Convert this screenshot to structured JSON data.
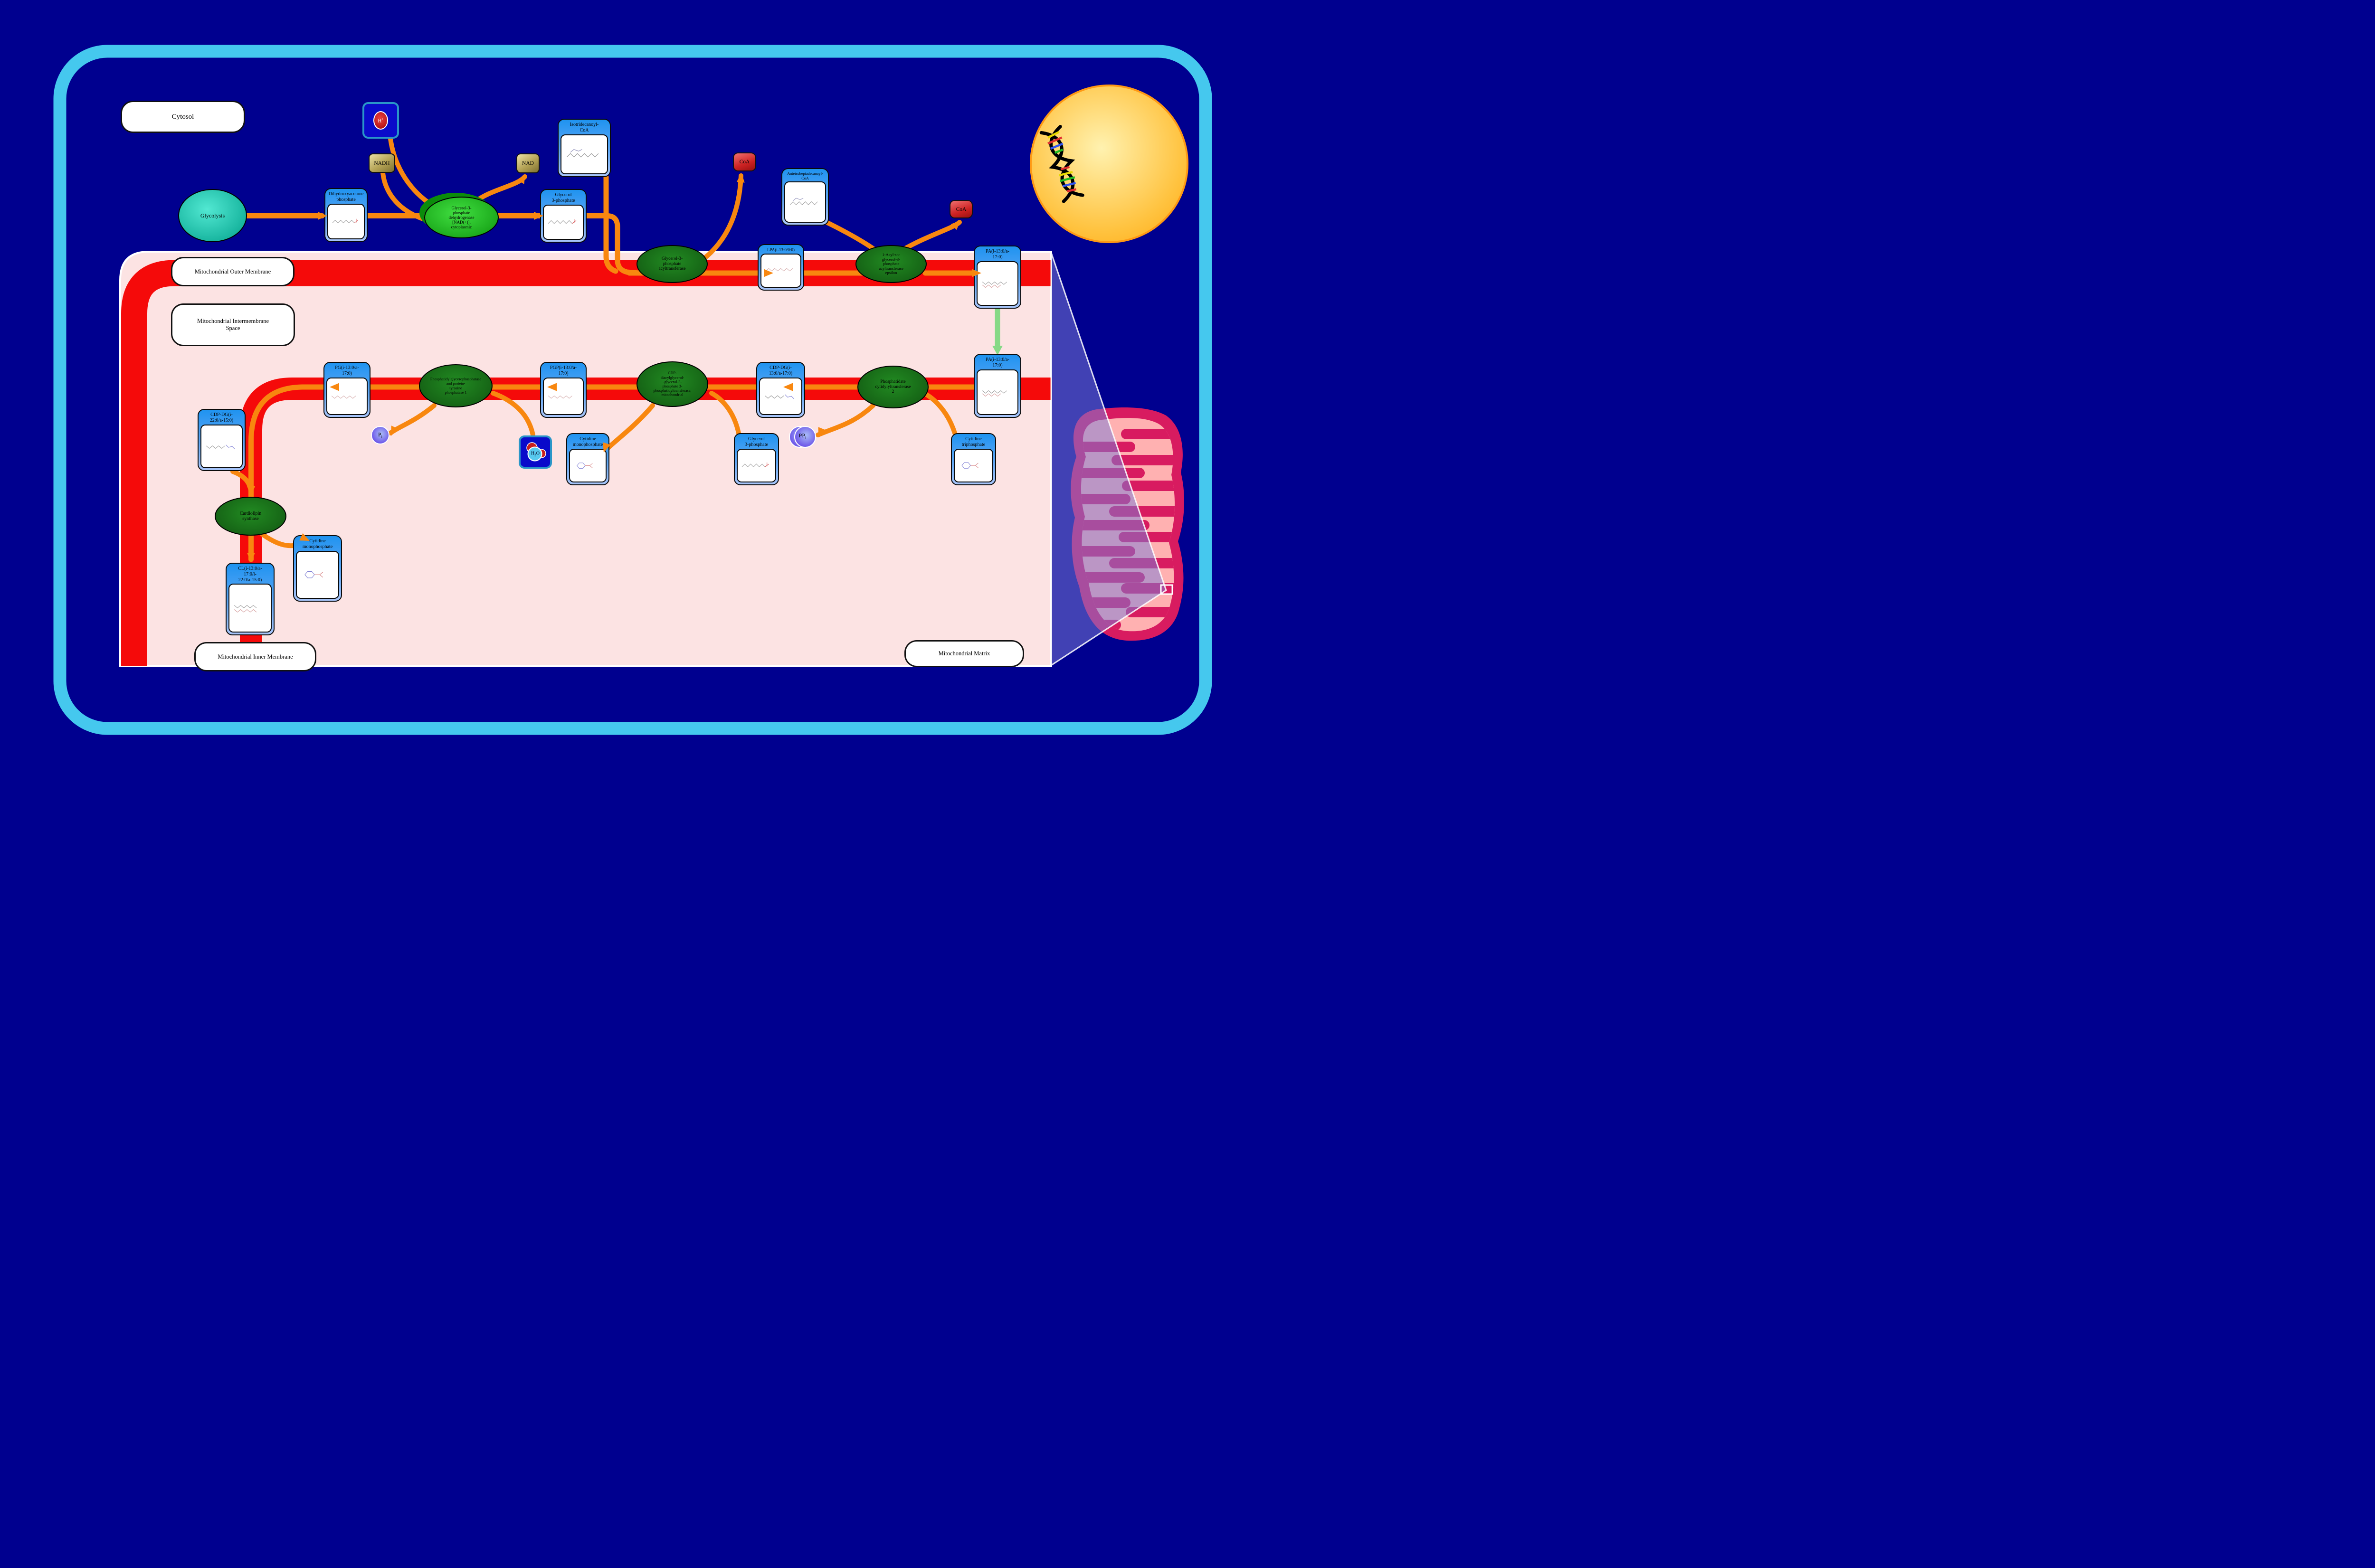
{
  "diagram_title": "Cardiolipin biosynthesis pathway",
  "compartment_labels": {
    "cytosol": "Cytosol",
    "outer_membrane": "Mitochondrial Outer Membrane",
    "intermembrane_space": "Mitochondrial Intermembrane\nSpace",
    "inner_membrane": "Mitochondrial Inner Membrane",
    "matrix": "Mitochondrial Matrix"
  },
  "processes": {
    "glycolysis": "Glycolysis"
  },
  "metabolites": {
    "dhap": "Dihydroxyacetone\nphosphate",
    "g3p_cytosol": "Glycerol\n3-phosphate",
    "iso_coa": "Isotridecanoyl-\nCoA",
    "anteiso_coa": "Anteisoheptadecanoyl-\nCoA",
    "lpa": "LPA(i-13:0/0:0)",
    "pa_outer": "PA(i-13:0/a-\n17:0)",
    "pa_inner": "PA(i-13:0/a-\n17:0)",
    "cdp_dg_1": "CDP-DG(i-\n13:0/a-17:0)",
    "pgp": "PGP(i-13:0/a-\n17:0)",
    "pg": "PG(i-13:0/a-\n17:0)",
    "cdp_dg_2": "CDP-DG(i-\n22:0/a-15:0)",
    "cl": "CL(i-13:0/a-\n17:0/i-\n22:0/a-15:0)",
    "cmp_upper": "Cytidine\nmonophosphate",
    "cmp_lower": "Cytidine\nmonophosphate",
    "g3p_matrix": "Glycerol\n3-phosphate",
    "ctp": "Cytidine\ntriphosphate"
  },
  "enzymes": {
    "g3p_dehydrogenase": "Glycerol-3-\nphosphate\ndehydrogenase\n[NAD(+)],\ncytoplasmic",
    "gpat": "Glycerol-3-\nphosphate\nacyltransferase",
    "agpat_epsilon": "1-Acyl-sn-\nglycerol-3-\nphosphate\nacyltransferase\nepsilon",
    "pcyt2": "Phosphatidate\ncytidylyltransferase\n2",
    "cds": "CDP-\ndiacylglycerol-\n-glycerol-3-\nphosphate 3-\nphosphatidyltransferase,\nmitochondrial",
    "ptpmt1": "Phosphatidylglycerophosphatase\nand protein-\ntyrosine\nphosphatase 1",
    "cardiolipin_synthase": "Cardiolipin\nsynthase"
  },
  "cofactors": {
    "nadh": "NADH",
    "nad": "NAD",
    "h_plus": {
      "base": "H",
      "sup": "+"
    },
    "coa_1": "CoA",
    "coa_2": "CoA",
    "pi": {
      "base": "P",
      "sub": "i"
    },
    "ppi": {
      "base": "PP",
      "sub": "i"
    },
    "h2o": {
      "base": "H",
      "sub": "2",
      "tail": "O"
    }
  },
  "colors": {
    "background_navy": "#00008F",
    "cell_border_blue": "#45C8EE",
    "panel_pink": "#FCE3E3",
    "membrane_red": "#F50A0A",
    "arrow_orange": "#F8870F",
    "transport_green": "#86D986",
    "enzyme_green_dark": "#1B7E1B",
    "enzyme_green_bright": "#2ECC2E",
    "metabolite_blue": "#2196F3",
    "cofactor_olive": "#B3A255",
    "coa_red": "#CC2222",
    "phosphate_purple": "#6A52E8",
    "mitochondrion_crimson": "#D81B60",
    "mitochondrion_pink": "#FFB1B1",
    "nucleus_gold": "#FFC02E"
  }
}
